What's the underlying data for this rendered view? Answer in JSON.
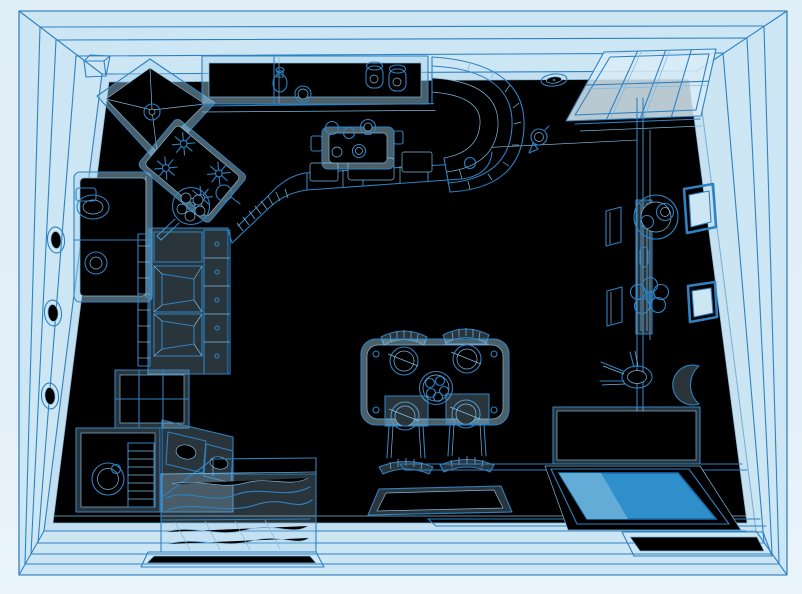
{
  "scene": {
    "description": "Blueprint-style blue wireframe illustration of a kitchen interior seen from above in perspective; no text is rendered in the image",
    "style": "monochrome blue technical line art",
    "palette": {
      "page_bg": "#e4f0f9",
      "wall_fill": "#cde6f4",
      "floor_fill": "#c4dff0",
      "line": "#2e82c2",
      "line_strong": "#1a6fb0",
      "line_soft": "#7db8dd",
      "fill_ghost": "#a9d4ec",
      "window_fill": "#d9ecf7",
      "mattress": "#2f8fca",
      "mattress_band": "#62acd7"
    },
    "elements": [
      {
        "name": "room-frame",
        "label": "perspective room walls with corner diagonals"
      },
      {
        "name": "wall-ovals",
        "label": "three oval plates on left wall"
      },
      {
        "name": "range-hood",
        "label": "corner extractor hood"
      },
      {
        "name": "gas-hob",
        "label": "diagonal gas hob with four burners and frying pan"
      },
      {
        "name": "upper-cabinets",
        "label": "wall cabinets holding bottle, jar and two mugs"
      },
      {
        "name": "counter-front",
        "label": "L-shaped base cabinet front with drawers"
      },
      {
        "name": "kitchen-sink",
        "label": "sink with tap knobs"
      },
      {
        "name": "curved-shelf-unit",
        "label": "curved open-shelf counter end"
      },
      {
        "name": "fridge",
        "label": "refrigerator with oval handle"
      },
      {
        "name": "pantry-shelves",
        "label": "open pantry shelf column"
      },
      {
        "name": "glass-door-cabinet",
        "label": "mullioned cabinet door"
      },
      {
        "name": "washing-machine",
        "label": "washing machine with round door"
      },
      {
        "name": "drawer-stack",
        "label": "striped drawer stack"
      },
      {
        "name": "angled-cabinet",
        "label": "angled lower cabinet with oval panels"
      },
      {
        "name": "window",
        "label": "paned window over door opening"
      },
      {
        "name": "door-post",
        "label": "vertical door frame post"
      },
      {
        "name": "wall-clock",
        "label": "oval wall clock"
      },
      {
        "name": "wall-lamp",
        "label": "small wall lamp"
      },
      {
        "name": "radiator-rack",
        "label": "wall-mounted rack with hub and flower of hooks"
      },
      {
        "name": "picture-frame-upper",
        "label": "tilted picture frame"
      },
      {
        "name": "picture-frame-lower",
        "label": "tilted picture frame"
      },
      {
        "name": "side-stool",
        "label": "small round stool"
      },
      {
        "name": "crescent-decor",
        "label": "crescent moon wall decoration"
      },
      {
        "name": "dining-table",
        "label": "table set with four plates and fruit bowl"
      },
      {
        "name": "dining-chairs",
        "label": "four arch-back chairs"
      },
      {
        "name": "bench",
        "label": "bench with dark blue cushion and backrest"
      },
      {
        "name": "floor-mat",
        "label": "small floor mat"
      },
      {
        "name": "pet-bed",
        "label": "box bed with wavy blanket on tray"
      }
    ]
  }
}
